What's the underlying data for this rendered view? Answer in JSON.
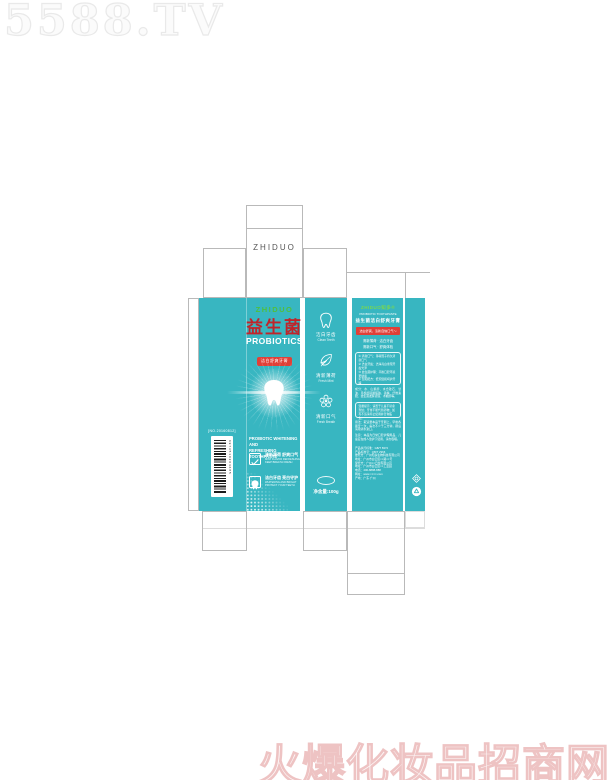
{
  "watermarks": {
    "top": "5588.TV",
    "bottom": "火爆化妆品招商网"
  },
  "colors": {
    "teal": "#38b6c1",
    "brand_green": "#4fbf3f",
    "title_red": "#c0242a",
    "badge_red": "#e04038",
    "dieline_gray": "#b9b9b9"
  },
  "dieline": {
    "top_flap_label": "ZHIDUO"
  },
  "front": {
    "brand": "ZHIDUO",
    "title_cn": "益生菌",
    "title_en": "PROBIOTICS",
    "badge": "洁白舒爽牙膏",
    "desc_line1": "PROBIOTIC WHITENING AND",
    "desc_line2": "REFRESHING TOOTHPASTE",
    "features": [
      {
        "icon": "leaf-check-icon",
        "cn": "清新薄荷 舒爽口气",
        "en": "MINT FLAVOR REFRESHING\nKEEP BREATH FRESH"
      },
      {
        "icon": "tooth-box-icon",
        "cn": "洁白牙齿 亮白守护",
        "en": "WHITENING AND BRIGHT\nPROTECT YOUR TEETH"
      }
    ]
  },
  "left_panel": {
    "code": "[NO.20160812]",
    "barcode_number": "6973510204685"
  },
  "side_panel": {
    "items": [
      {
        "icon": "tooth-icon",
        "cn": "洁白牙齿",
        "en": "Clean Teeth"
      },
      {
        "icon": "leaf-icon",
        "cn": "清新薄荷",
        "en": "Fresh Mint"
      },
      {
        "icon": "flower-icon",
        "cn": "清新口气",
        "en": "Fresh Breath"
      }
    ],
    "net_weight": "净含量:100g"
  },
  "back": {
    "brand": "ZHIDUO知多®",
    "en": "PROBIOTIC TOOTHPASTE",
    "cn": "益生菌洁白舒爽牙膏",
    "banner": "洁白舒爽，清新自信口气～",
    "slogan1": "清新薄荷 · 洁白牙齿",
    "slogan2": "清新口气 · 舒爽体验",
    "points": [
      "① 清新口气：薄荷因子持久清新口气",
      "② 洁白牙齿：洁净亮白重现牙齿光泽",
      "③ 益生菌护理：平衡口腔环境更健康",
      "④ 温和配方：低泡温和呵护牙龈"
    ],
    "ingredients": "成分：水、山梨醇、水合硅石、甘油、月桂醇硫酸酯钠、香精、纤维素胶、益生菌发酵滤液、木糖醇等。",
    "tips": "温馨提示：请置于儿童不易拿到处；牙膏不能代替药物；如有不适请停止使用并咨询医生。",
    "usage": "用法：取适量本品于牙刷上，早晚各刷牙一次，每次不少于三分钟，刷后请用清水漱口。",
    "caution": "注意：本品为日常口腔护理用品，儿童应在成人监护下使用，请勿吞咽。",
    "info": "产品执行标准：GB/T 8372\n产品标准号：QB/T 2966\n委托方：广州知多生物科技有限公司\n地址：广州市白云区××路××号\n受托方：广州××日化有限公司\n地址：广州市白云区××工业园\n电话：400-8888-888\n网址：www.××××.com\n产地：广东·广州"
  }
}
